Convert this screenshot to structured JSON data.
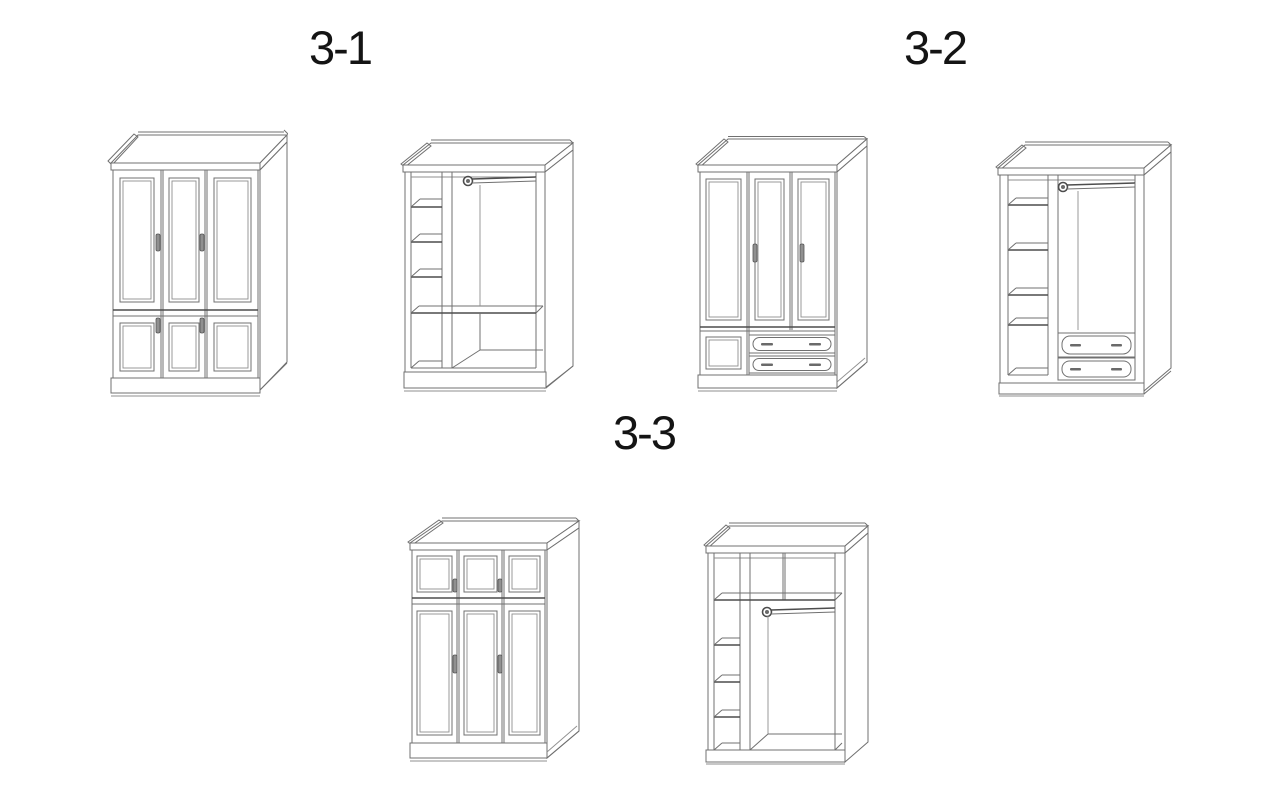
{
  "page": {
    "background": "#ffffff",
    "line_color": "#707070",
    "emphasis_line_color": "#4d4d4d",
    "text_color": "#141414"
  },
  "figures": [
    {
      "id": "3-1",
      "label": "3-1",
      "views": [
        {
          "name": "closed-three-door-wardrobe"
        },
        {
          "name": "open-wardrobe-interior-shelves-and-hanging-rod"
        }
      ]
    },
    {
      "id": "3-2",
      "label": "3-2",
      "views": [
        {
          "name": "closed-three-door-wardrobe-with-two-drawers"
        },
        {
          "name": "open-wardrobe-interior-shelves-rod-and-two-drawers"
        }
      ]
    },
    {
      "id": "3-3",
      "label": "3-3",
      "views": [
        {
          "name": "closed-three-door-wardrobe-with-top-compartments"
        },
        {
          "name": "open-wardrobe-interior-top-shelf-shelves-and-rod"
        }
      ]
    }
  ]
}
